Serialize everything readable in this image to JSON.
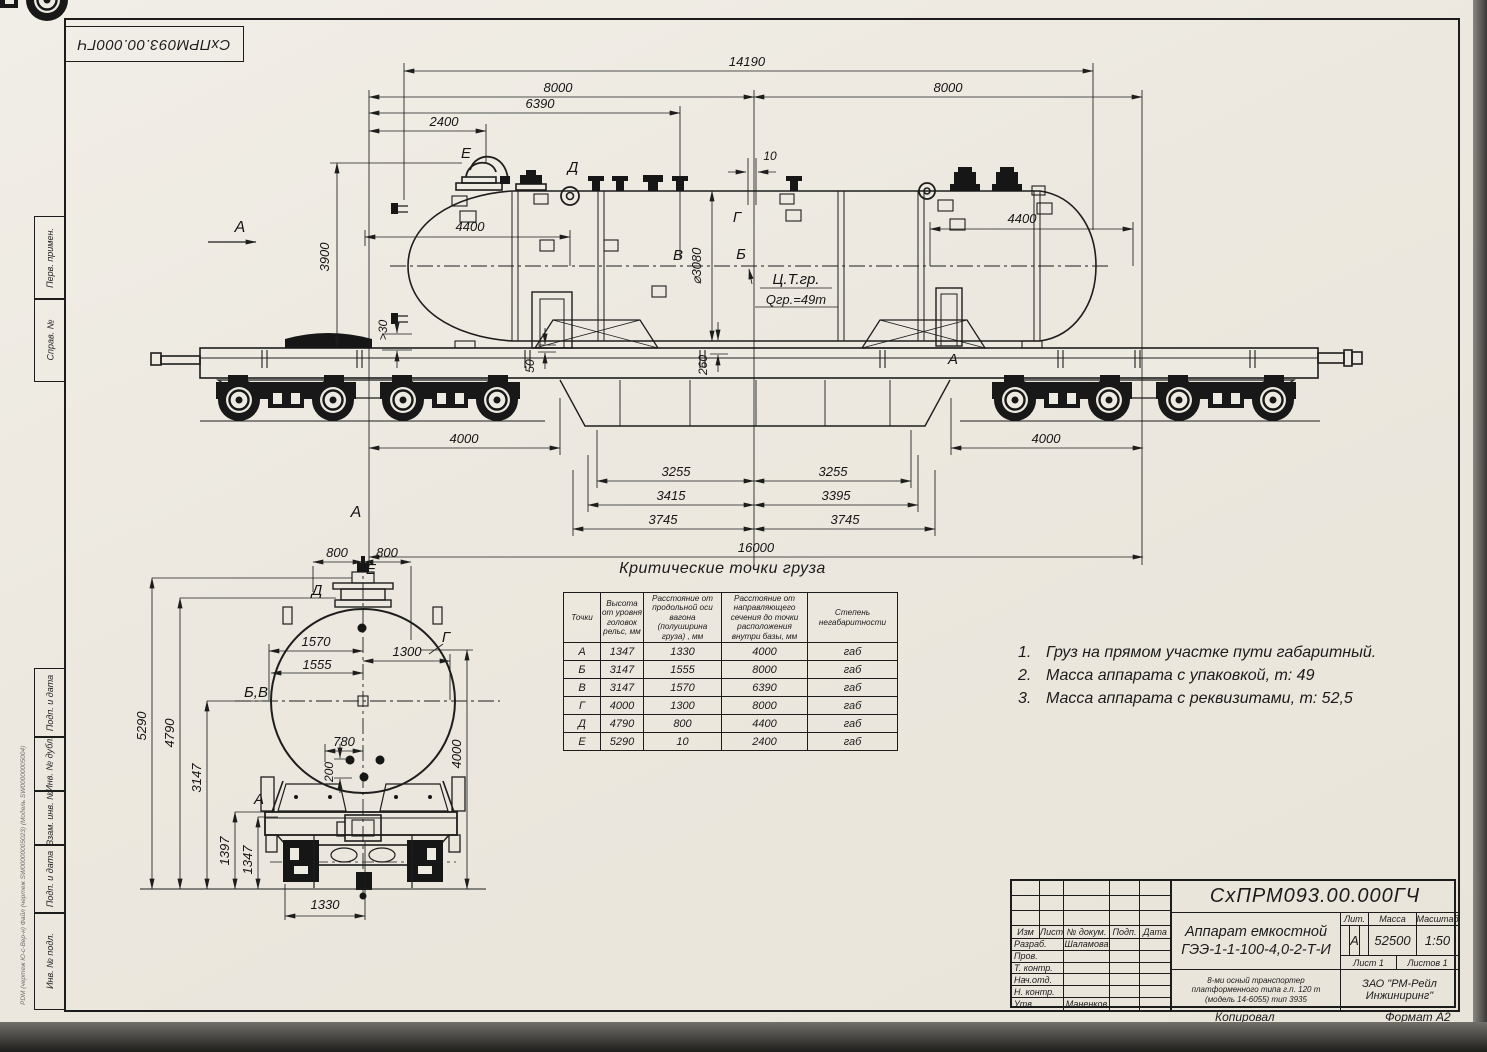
{
  "sheet": {
    "stamp_top": "СхПРМ093.00.000ГЧ",
    "margin_labels": [
      "Перв. примен.",
      "Справ. №",
      "Подп. и дата",
      "Инв. № дубл.",
      "Взам. инв. №",
      "Подп. и дата",
      "Инв. № подл."
    ],
    "pdm_line": "PDM (чертеж Ю-с-Вер-н) Файл (чертеж SW00000005023) (Модель SW00000005004)"
  },
  "side_view": {
    "view_label": "А",
    "dims": {
      "overall": "14190",
      "left8000": "8000",
      "right8000": "8000",
      "d6390": "6390",
      "d2400": "2400",
      "d10": "10",
      "d3900": "3900",
      "gap30": ">30",
      "left4400": "4400",
      "right4400": "4400",
      "dia": "⌀3080",
      "d50": "50",
      "d260": "260",
      "left3255": "3255",
      "right3255": "3255",
      "d3415": "3415",
      "d3395": "3395",
      "left3745": "3745",
      "right3745": "3745",
      "left4000": "4000",
      "right4000": "4000",
      "base": "16000"
    },
    "points": {
      "e": "Е",
      "d": "Д",
      "v": "В",
      "b": "Б",
      "g": "Г",
      "a": "А"
    },
    "cg_label": "Ц.Т.гр.",
    "cg_mass": "Qгр.=49т"
  },
  "front_view": {
    "view_label": "А",
    "dims": {
      "left800": "800",
      "right800": "800",
      "d1570": "1570",
      "d1555": "1555",
      "d1300": "1300",
      "d780": "780",
      "d200": "200",
      "d5290": "5290",
      "d4790": "4790",
      "d3147": "3147",
      "d1397": "1397",
      "d1347": "1347",
      "d4000": "4000",
      "d1330": "1330"
    },
    "points": {
      "e": "Е",
      "d": "Д",
      "g": "Г",
      "bv": "Б,В",
      "a": "А"
    }
  },
  "crit_table": {
    "title": "Критические точки груза",
    "headers": [
      "Точки",
      "Высота от уровня головок рельс, мм",
      "Расстояние от продольной оси вагона (полуширина груза) , мм",
      "Расстояние от направляющего сечения до точки расположения внутри базы, мм",
      "Степень негабаритности"
    ],
    "rows": [
      [
        "А",
        "1347",
        "1330",
        "4000",
        "габ"
      ],
      [
        "Б",
        "3147",
        "1555",
        "8000",
        "габ"
      ],
      [
        "В",
        "3147",
        "1570",
        "6390",
        "габ"
      ],
      [
        "Г",
        "4000",
        "1300",
        "8000",
        "габ"
      ],
      [
        "Д",
        "4790",
        "800",
        "4400",
        "габ"
      ],
      [
        "Е",
        "5290",
        "10",
        "2400",
        "габ"
      ]
    ]
  },
  "notes": [
    {
      "num": "1.",
      "text": "Груз на прямом участке пути габаритный."
    },
    {
      "num": "2.",
      "text": "Масса аппарата с упаковкой, т: 49"
    },
    {
      "num": "3.",
      "text": "Масса аппарата с реквизитами, т: 52,5"
    }
  ],
  "title_block": {
    "doc_number": "СхПРМ093.00.000ГЧ",
    "change_cols": [
      "Изм",
      "Лист",
      "№ докум.",
      "Подп.",
      "Дата"
    ],
    "sign_rows": [
      {
        "role": "Разраб.",
        "name": "Шаламова"
      },
      {
        "role": "Пров.",
        "name": ""
      },
      {
        "role": "Т. контр.",
        "name": ""
      },
      {
        "role": "Нач.отд.",
        "name": ""
      },
      {
        "role": "Н. контр.",
        "name": ""
      },
      {
        "role": "Утв.",
        "name": "Маненков"
      }
    ],
    "product_line1": "Аппарат емкостной",
    "product_line2": "ГЭЭ-1-1-100-4,0-2-Т-И",
    "lit_header": "Лит.",
    "mass_header": "Масса",
    "scale_header": "Масштаб",
    "lit_value": "А",
    "mass_value": "52500",
    "scale_value": "1:50",
    "sheet_info": "Лист 1",
    "sheets_info": "Листов 1",
    "transporter_note": "8-ми осный транспортер платформенного типа г.п. 120 т (модель 14-6055) тип 3935",
    "company": "ЗАО \"РМ-Рейл Инжиниринг\"",
    "copied": "Копировал",
    "format": "Формат А2"
  }
}
